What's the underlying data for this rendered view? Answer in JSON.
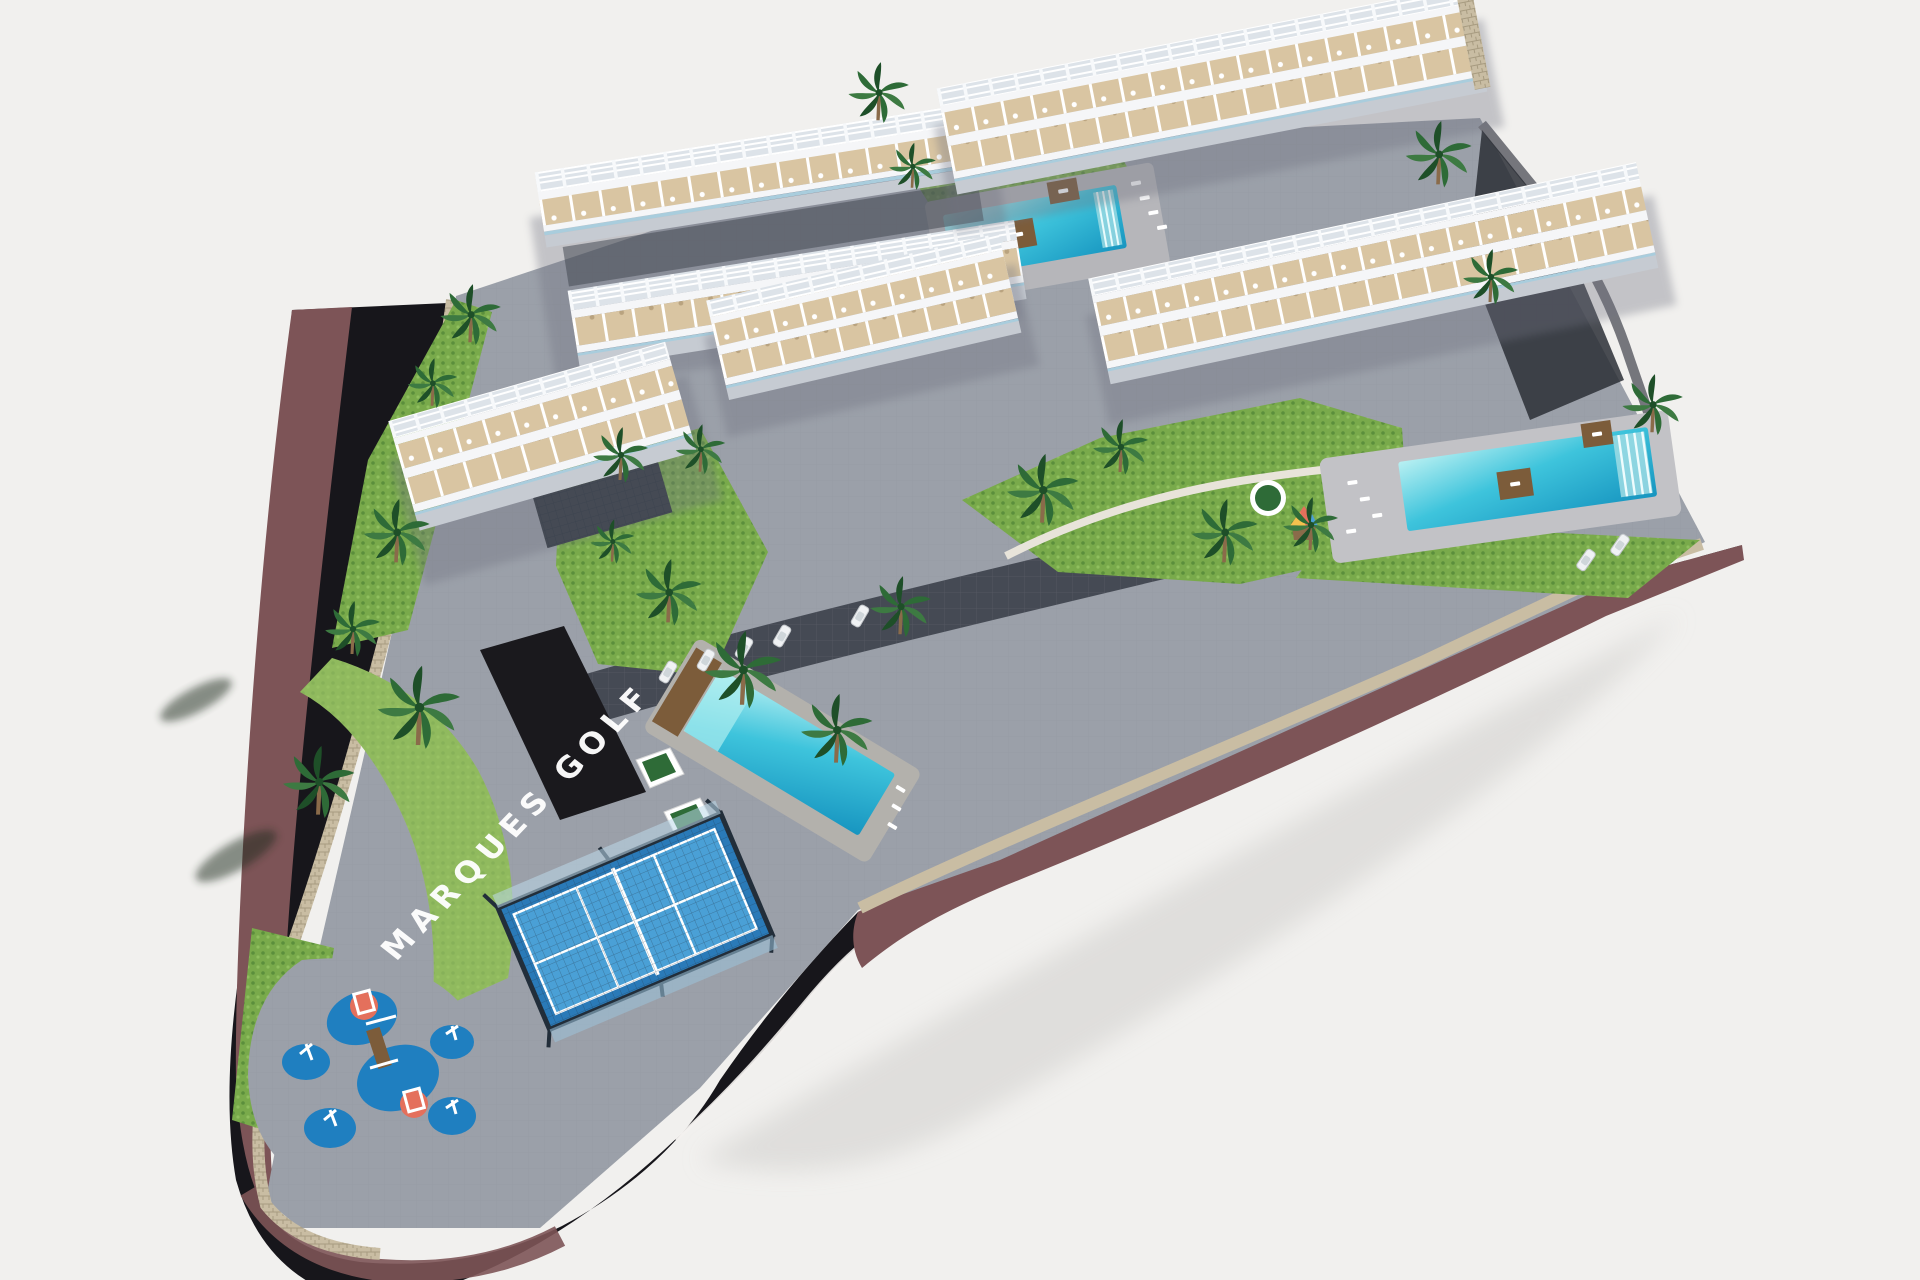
{
  "scene": {
    "description": "Aerial 3D architectural rendering of the MARQUES GOLF residential complex on a white background",
    "view": "isometric aerial view"
  },
  "signage": {
    "estate_name": "MARQUES GOLF"
  },
  "inventory": {
    "apartment_buildings": 5,
    "swimming_pools": 3,
    "padel_courts": 1,
    "playgrounds": 1,
    "visible_cars": 7
  },
  "colors": {
    "background": "#f1f0ee",
    "road": "#17161b",
    "sidewalk": "#7d5457",
    "curb": "#f3f1ee",
    "wall_beige": "#c9bda3",
    "wall_stone": "#75767c",
    "paver": "#9ba0a9",
    "paver_line": "#8b9099",
    "drive": "#454a54",
    "entrance": "#1a191d",
    "lawn": "#79aa4b",
    "lawn_dark": "#5b8f3c",
    "hedge": "#9dc368",
    "palm": "#2e6b37",
    "palm_dark": "#1e4f28",
    "trunk": "#8a6b4a",
    "building": "#f5f6f8",
    "building_side": "#c6cbd2",
    "pergola_base": "#dde3e9",
    "terrace": "#d9c5a2",
    "glass": "#a9cddd",
    "pool_light": "#aeeef0",
    "pool_water": "#3ec4dc",
    "pool_deep": "#1795c0",
    "deck": "#b6b6ba",
    "wood": "#7c5c3a",
    "padel_court": "#2a7ab8",
    "padel_court_light": "#4aa0d6",
    "padel_cage": "#222e3a",
    "play_blue": "#1f7fc0",
    "play_red": "#e4705c",
    "car": "#f0f2f4",
    "shadow": "#d9d8d6",
    "text": "#ffffff"
  }
}
